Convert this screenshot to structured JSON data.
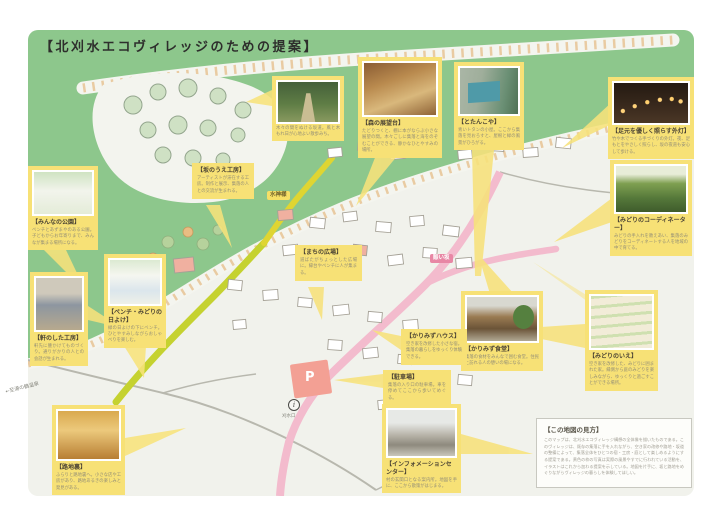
{
  "page": {
    "title": "【北刈水エコヴィレッジのための提案】"
  },
  "colors": {
    "map_green": "#8dc78c",
    "card_yellow": "#f7e176",
    "road_pink": "#f3bbcd",
    "road_green": "#c5d230",
    "road_yellow": "#dfd532",
    "parking_salmon": "#f3a094",
    "tag_pink": "#e887a5"
  },
  "tags": {
    "water_deity": "水神様",
    "pink_road_name": "賑い坂",
    "parking_mark": "P",
    "info_mark": "i",
    "bus_stop": "刈水口",
    "direction_note": "←至湯の鶴温泉"
  },
  "callouts": [
    {
      "id": "forest-path",
      "title": "",
      "caption": "木々の間をぬける坂道。風と木もれ日が心地よい散歩みち。"
    },
    {
      "id": "mori-tenbodai",
      "title": "【森の展望台】",
      "caption": "たどりつくと、棚に本がならぶ小さな展望の間。木々ごしに集落と海をのぞむことができる、静かなひとやすみの場所。"
    },
    {
      "id": "totankoya",
      "title": "【とたんこや】",
      "caption": "青いトタンの小屋。ここから集落を見おろすと、屋根と緑の風景がひろがる。"
    },
    {
      "id": "gaito",
      "title": "【足元を優しく照らす外灯】",
      "caption": "竹や木でつくる手づくりの外灯。夜、足もとをやさしく照らし、坂の夜道も安心して歩ける。"
    },
    {
      "id": "coordinator",
      "title": "【みどりのコーディネーター】",
      "caption": "みどりの手入れを教えあい、集落のみどりをコーディネートする人を地域の中で育てる。"
    },
    {
      "id": "midori-no-ie",
      "title": "【みどりのいえ】",
      "caption": "空き家を改修した、みどりに囲まれた家。縁側から庭のみどりを楽しみながら、ゆっくりと過ごすことができる場所。"
    },
    {
      "id": "karimizu-shokudo",
      "title": "【かりみず食堂】",
      "caption": "集落の食材をみんなで囲む食堂。住民と訪れる人の憩いの場になる。"
    },
    {
      "id": "karimizu-house",
      "title": "【かりみずハウス】",
      "caption": "空き家を改修した小さな宿。集落の暮らしをゆっくり体験できる。"
    },
    {
      "id": "parking",
      "title": "【駐車場】",
      "caption": "集落の入り口の駐車場。車を停めてここから歩いてめぐる。"
    },
    {
      "id": "information-center",
      "title": "【インフォメーションセンター】",
      "caption": "村の玄関口となる案内所。地図を手に、ここから散策がはじまる。"
    },
    {
      "id": "rojiura",
      "title": "【路地裏】",
      "caption": "ふらりと路地裏へ。小さな店や工房があり、路地あるきの楽しみと発見がある。"
    },
    {
      "id": "noki-no-shita",
      "title": "【軒のした工房】",
      "caption": "軒先に腰かけてものづくり。通りがかりの人との会話が生まれる。"
    },
    {
      "id": "minna-no-kouen",
      "title": "【みんなの公園】",
      "caption": "ベンチとあずまやのある公園。子どもからお年寄りまで、みんなが集まる場所になる。"
    },
    {
      "id": "bench-hiyoke",
      "title": "【ベンチ・みどりの日よけ】",
      "caption": "緑の日よけの下にベンチ。ひとやすみしながらおしゃべりを楽しむ。"
    },
    {
      "id": "saka-no-ue",
      "title": "【坂のうえ工房】",
      "caption": "アーティストが滞在する工房。制作と展示、集落の人との交流が生まれる。"
    },
    {
      "id": "machi-no-hiroba",
      "title": "【まちの広場】",
      "caption": "道ばたがちょっとした広場に。縁台やベンチに人が集まる。"
    }
  ],
  "legend": {
    "title": "【この地図の見方】",
    "body": "このマップは、北刈水エコヴィレッジ構想の全体像を描いたものである。このヴィレッジは、既存の集落に手を入れながら、空き家の改修や路地・坂道の整備によって、集落全体をひとつの宿・工房・庭として楽しめるようにする提案である。黄色の枠の写真は実際の風景やすでに行われている活動を、イラストはこれから加わる提案を示している。地図を片手に、坂と路地をめぐりながらヴィレッジの暮らしを体験してほしい。"
  }
}
